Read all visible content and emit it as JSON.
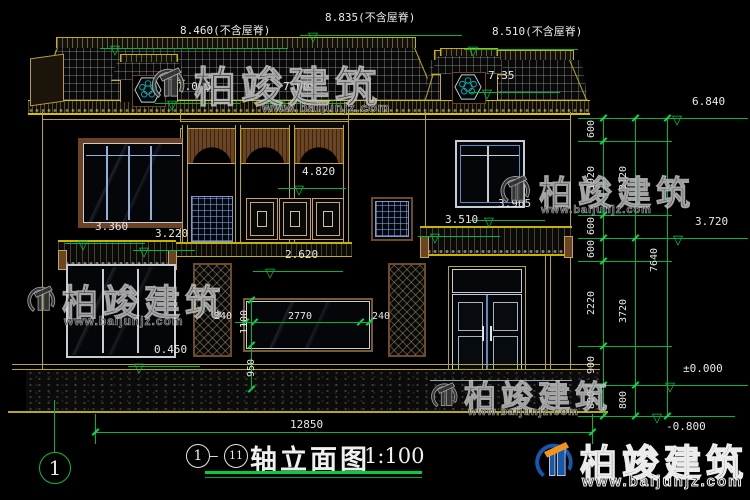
{
  "meta": {
    "sheet_axis_bubble": "1"
  },
  "title": {
    "axis_start": "1",
    "axis_end": "11",
    "text": "轴立面图",
    "scale": "1:100"
  },
  "top_dims": {
    "total": "8.835(不含屋脊)",
    "left": "8.460(不含屋脊)",
    "right": "8.510(不含屋脊)"
  },
  "levels": {
    "eave_left_a": "7.005",
    "eave_left_b": "7.005",
    "eave_right": "7.35",
    "balcony": "4.820",
    "veranda_sill": "2.620",
    "canopy_entry_top": "3.965",
    "canopy_entry_eave": "3.510",
    "canopy_bay_top": "3.360",
    "canopy_bay_eave": "3.220",
    "plinth": "0.450",
    "right_upper": "6.840",
    "right_mid": "3.720",
    "right_zero": "±0.000",
    "right_ground": "-0.800"
  },
  "window_dims": {
    "jamb_left": "240",
    "width": "2770",
    "jamb_right": "240",
    "height": "1100",
    "sill": "950"
  },
  "chains": {
    "a": [
      "600",
      "1920",
      "600",
      "600",
      "2220",
      "900",
      "800"
    ],
    "b": [
      "3120",
      "3720",
      "800"
    ],
    "c": [
      "7640"
    ]
  },
  "bottom_dim": "12850",
  "watermark": {
    "brand": "柏竣建筑",
    "url": "www.baijunjz.com"
  },
  "colors": {
    "line_yellow": "#d4c400",
    "dim_green": "#00c040",
    "text_white": "#e8e8e8",
    "wood_brown": "#6b4423",
    "sash_blue": "#5a8ac0",
    "flower_teal": "#17a3a8",
    "logo_blue": "#1558b0",
    "logo_orange": "#f0941e"
  }
}
